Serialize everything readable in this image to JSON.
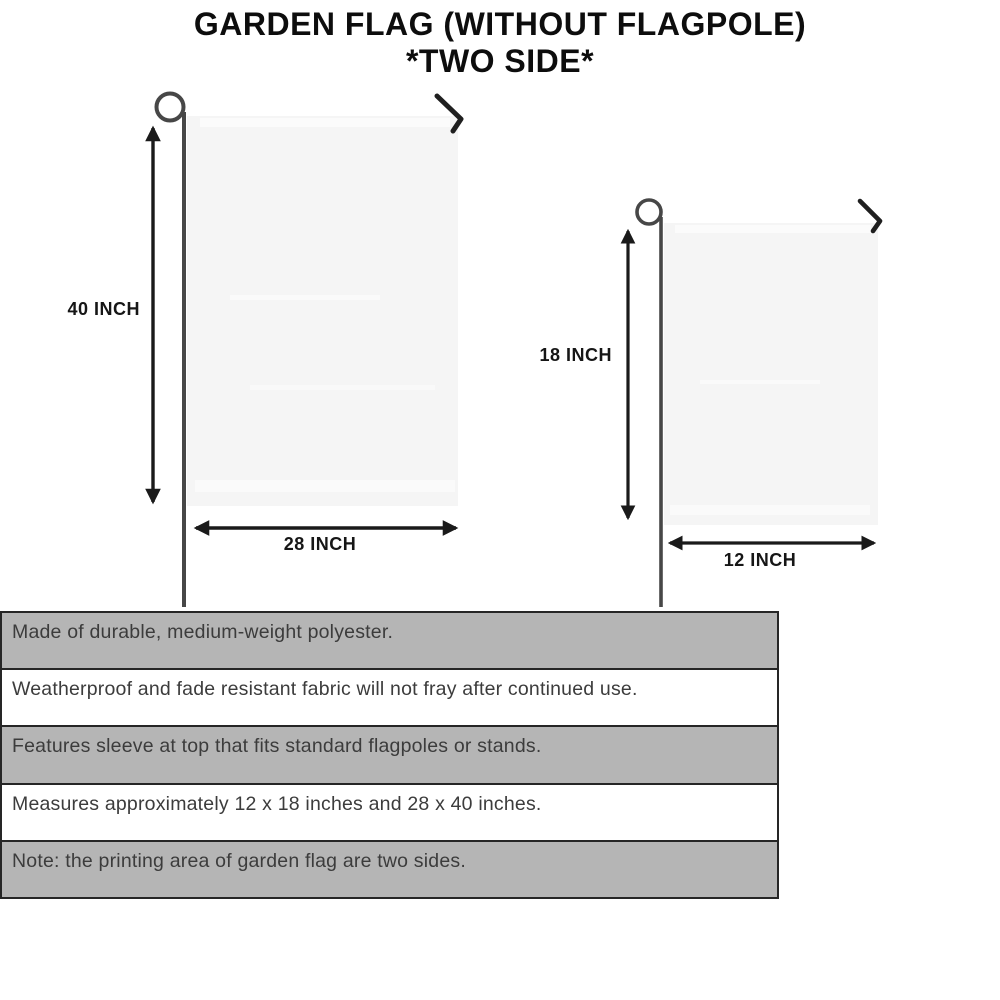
{
  "title": {
    "line1": "GARDEN FLAG (WITHOUT FLAGPOLE)",
    "line2": "*TWO SIDE*"
  },
  "flags": {
    "large": {
      "height_label": "40 INCH",
      "width_label": "28 INCH"
    },
    "small": {
      "height_label": "18 INCH",
      "width_label": "12 INCH"
    }
  },
  "features": [
    "Made of durable, medium-weight polyester.",
    "Weatherproof and fade resistant fabric will not fray after continued use.",
    "Features sleeve at top that fits standard flagpoles or stands.",
    "Measures approximately 12 x 18 inches and 28 x 40 inches.",
    "Note: the printing area of garden flag are two sides."
  ],
  "colors": {
    "row_gray": "#b5b5b5",
    "row_white": "#ffffff",
    "table_border": "#262626",
    "flag_fill": "#f5f5f5",
    "pole": "#474747",
    "arrow": "#1a1a1a",
    "title_text": "#0d0d0d",
    "feature_text": "#3c3c3c"
  }
}
